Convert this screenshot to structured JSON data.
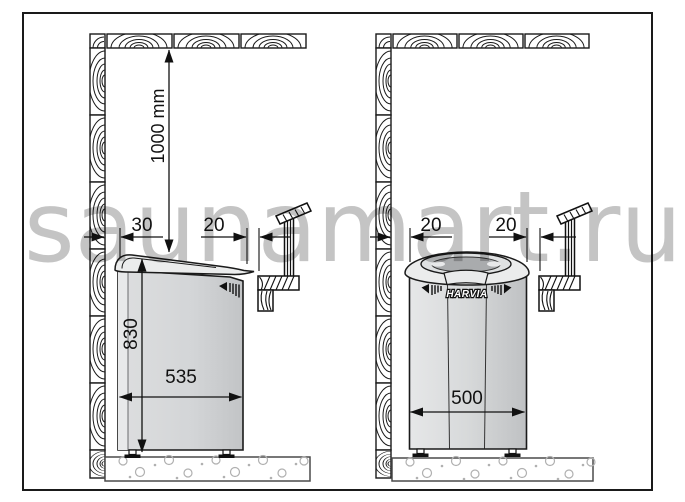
{
  "watermark": "saunamart.ru",
  "brand_logo": "HARVIA",
  "left_panel": {
    "ceiling_clearance_label": "1000 mm",
    "wall_gap_label": "30",
    "rail_gap_label": "20",
    "height_label": "830",
    "width_label": "535"
  },
  "right_panel": {
    "wall_gap_label": "20",
    "rail_gap_label": "20",
    "width_label": "500"
  },
  "colors": {
    "line": "#1a1a1a",
    "heater_body": "#d6d8da",
    "heater_highlight": "#eaebec",
    "watermark": "#8a8a8a",
    "floor_stipple": "#b0b0b0"
  }
}
